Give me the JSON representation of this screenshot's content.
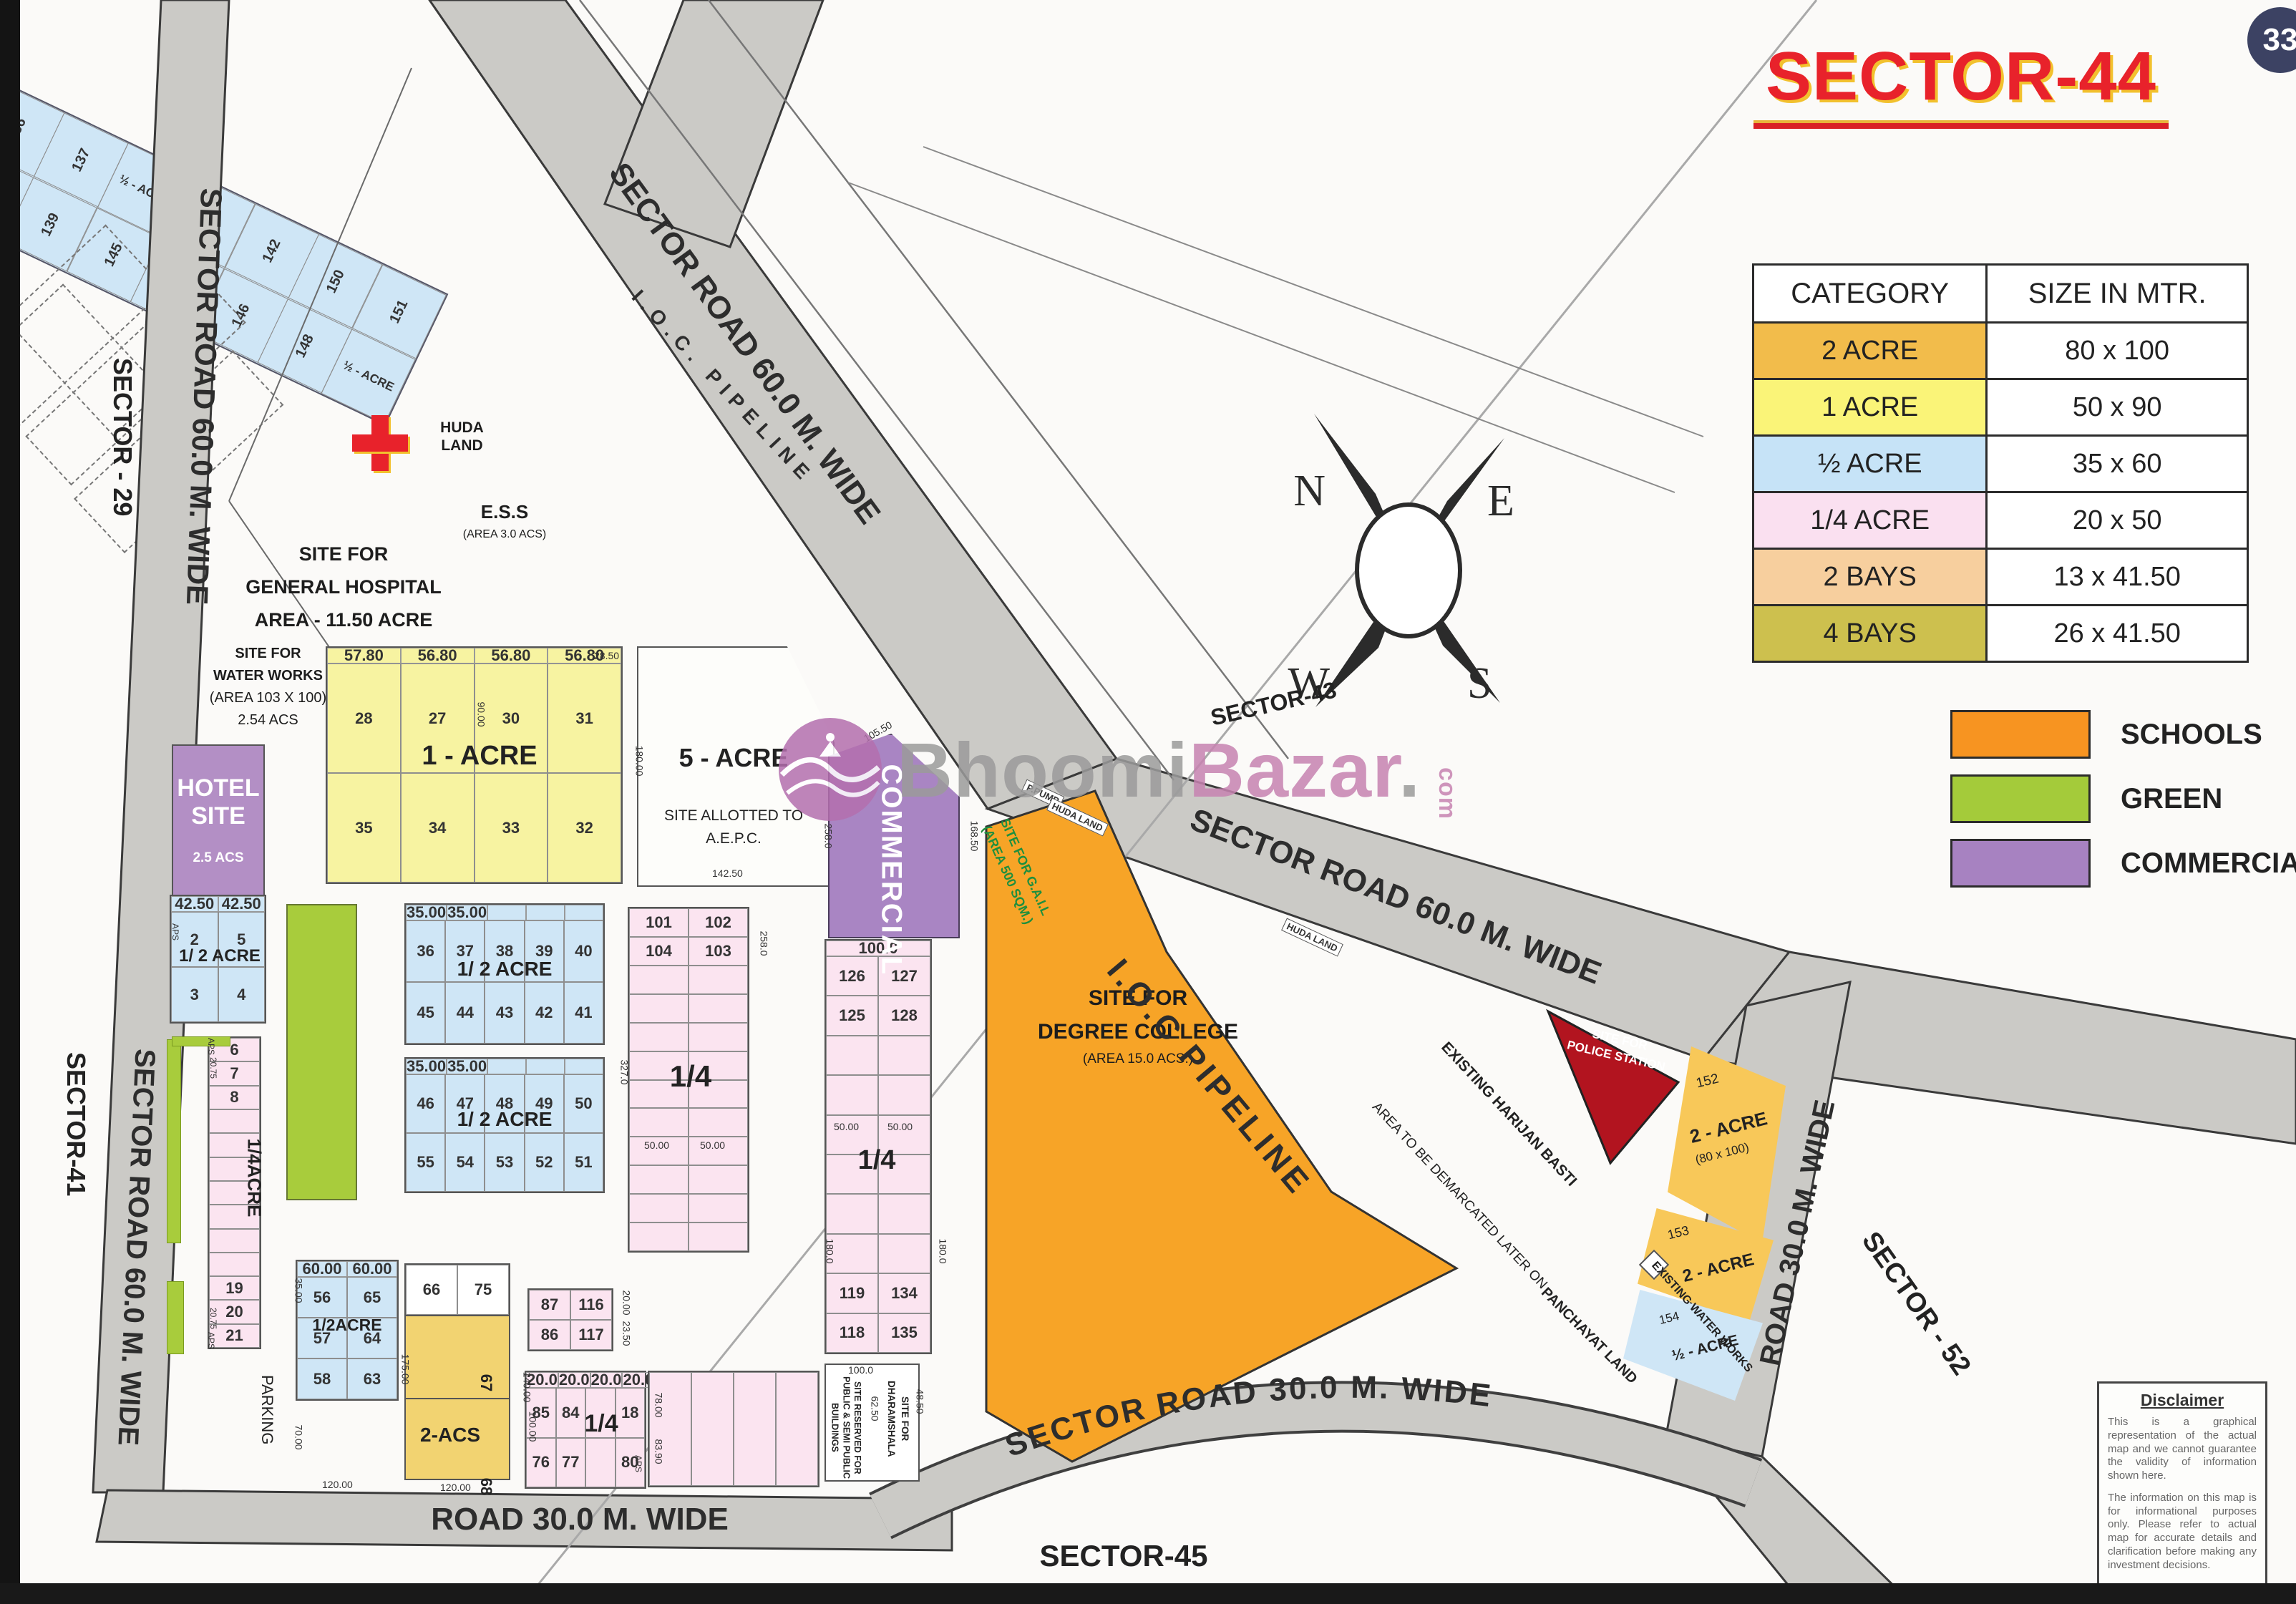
{
  "title": {
    "text": "SECTOR-44",
    "badge": "33"
  },
  "category_table": {
    "headers": [
      "CATEGORY",
      "SIZE IN MTR."
    ],
    "rows": [
      {
        "category": "2 ACRE",
        "size": "80 x 100",
        "color": "#f2bc4b"
      },
      {
        "category": "1 ACRE",
        "size": "50 x 90",
        "color": "#faf478"
      },
      {
        "category": "½ ACRE",
        "size": "35 x 60",
        "color": "#c6e3f7"
      },
      {
        "category": "1/4 ACRE",
        "size": "20 x 50",
        "color": "#fae0f0"
      },
      {
        "category": "2 BAYS",
        "size": "13 x 41.50",
        "color": "#f7cf9e"
      },
      {
        "category": "4 BAYS",
        "size": "26 x 41.50",
        "color": "#cdc04e"
      }
    ]
  },
  "legend": [
    {
      "label": "SCHOOLS",
      "color": "#f79421"
    },
    {
      "label": "GREEN",
      "color": "#a4cb3a"
    },
    {
      "label": "COMMERCIAL",
      "color": "#a782c1"
    }
  ],
  "compass": {
    "n": "N",
    "e": "E",
    "w": "W",
    "s": "S"
  },
  "watermark": {
    "part1": "Bhoomi",
    "part2": "Bazar",
    "dot": ".",
    "part3": "com"
  },
  "roads": {
    "left_60_a": "SECTOR ROAD 60.0 M. WIDE",
    "left_60_b": "SECTOR ROAD 60.0 M. WIDE",
    "diag_60_a": "SECTOR ROAD 60.0 M. WIDE",
    "diag_60_b": "SECTOR ROAD 60.0 M. WIDE",
    "right_30": "ROAD 30.0 M. WIDE",
    "bottom_30": "ROAD 30.0 M. WIDE",
    "curve_30": "SECTOR ROAD 30.0 M. WIDE",
    "ioc_top": "I.O.C. PIPELINE",
    "ioc_mid": "I.O.C PIPELINE"
  },
  "sectors": {
    "s29": "SECTOR - 29",
    "s41": "SECTOR-41",
    "s43": "SECTOR-43",
    "s45": "SECTOR-45",
    "s52": "SECTOR - 52"
  },
  "sites": {
    "hospital": [
      "SITE FOR",
      "GENERAL HOSPITAL",
      "AREA - 11.50 ACRE"
    ],
    "huda": [
      "HUDA",
      "LAND"
    ],
    "ess": "E.S.S",
    "ess_area": "(AREA 3.0 ACS)",
    "water_works": [
      "SITE FOR",
      "WATER WORKS",
      "(AREA 103 X 100)",
      "2.54 ACS"
    ],
    "hotel": [
      "HOTEL",
      "SITE",
      "2.5 ACS"
    ],
    "five_acre": "5 - ACRE",
    "aepc1": "SITE ALLOTTED TO",
    "aepc2": "A.E.P.C.",
    "commercial": "COMMERCIAL",
    "gail1": "SITE FOR G.A.I.L",
    "gail2": "(AREA 500 SQM.)",
    "college": [
      "SITE FOR",
      "DEGREE COLLEGE",
      "(AREA 15.0 ACS.)"
    ],
    "police": [
      "SITE FOR",
      "POLICE STATION"
    ],
    "dharamshala": [
      "SITE FOR",
      "DHARAMSHALA"
    ],
    "public_bldg": [
      "SITE RESERVED FOR",
      "PUBLIC & SEMI PUBLIC",
      "BUILDINGS"
    ],
    "harijan": "EXISTING HARIJAN BASTI",
    "demarcated": "AREA TO BE DEMARCATED LATER ON",
    "panchayat": "PANCHAYAT LAND",
    "eww": "EXISTING WATER WORKS",
    "parking": "PARKING",
    "huda_small": "HUDA LAND",
    "ppump": "P.PUMP"
  },
  "blocks": {
    "one_acre": {
      "dims_top": [
        "57.80",
        "56.80",
        "56.80",
        "56.80"
      ],
      "rows": [
        [
          "28",
          "27",
          "30",
          "31"
        ],
        [
          "35",
          "34",
          "33",
          "32"
        ]
      ],
      "label": "1 - ACRE"
    },
    "half_a": {
      "dims_top": [
        "42.50",
        "42.50"
      ],
      "rows": [
        [
          "2",
          "5"
        ],
        [
          "3",
          "4"
        ]
      ],
      "label": "1/ 2 ACRE"
    },
    "half_b": {
      "dims_top": [
        "35.00",
        "35.00",
        "",
        "",
        ""
      ],
      "rows": [
        [
          "36",
          "37",
          "38",
          "39",
          "40"
        ],
        [
          "45",
          "44",
          "43",
          "42",
          "41"
        ]
      ],
      "label": "1/ 2 ACRE"
    },
    "half_c": {
      "dims_top": [
        "35.00",
        "35.00",
        "",
        "",
        ""
      ],
      "rows": [
        [
          "46",
          "47",
          "48",
          "49",
          "50"
        ],
        [
          "55",
          "54",
          "53",
          "52",
          "51"
        ]
      ],
      "label": "1/ 2 ACRE"
    },
    "half_d": {
      "dims_top": [
        "60.00",
        "60.00"
      ],
      "rows": [
        [
          "56",
          "65"
        ],
        [
          "57",
          "64"
        ],
        [
          "58",
          "63"
        ]
      ],
      "label": "1/2ACRE"
    },
    "r59": "59 TO 62",
    "two_acs": {
      "top": [
        "66",
        "75"
      ],
      "label": "2-ACS",
      "n67": "67",
      "n68": "68"
    },
    "pink_strip": {
      "cells": [
        "6",
        "7",
        "8",
        "",
        "",
        "",
        "",
        "",
        "",
        "",
        "19",
        "20",
        "21"
      ],
      "label": "1/4ACRE"
    },
    "pink_big": {
      "rows": [
        [
          "101",
          "102"
        ],
        [
          "104",
          "103"
        ],
        [
          "",
          ""
        ],
        [
          "",
          ""
        ],
        [
          "",
          ""
        ],
        [
          "",
          ""
        ],
        [
          "",
          ""
        ],
        [
          "",
          ""
        ],
        [
          "",
          ""
        ],
        [
          "",
          ""
        ],
        [
          "",
          ""
        ],
        [
          "",
          ""
        ]
      ],
      "label": "1/4"
    },
    "center_pink": {
      "dims_top": [
        "100.0"
      ],
      "rows": [
        [
          "126",
          "127"
        ],
        [
          "125",
          "128"
        ],
        [
          "",
          ""
        ],
        [
          "",
          ""
        ],
        [
          "",
          ""
        ],
        [
          "",
          ""
        ],
        [
          "",
          ""
        ],
        [
          "",
          ""
        ],
        [
          "119",
          "134"
        ],
        [
          "118",
          "135"
        ]
      ],
      "label": "1/4"
    },
    "pink87": {
      "rows": [
        [
          "87",
          "116"
        ],
        [
          "86",
          "117"
        ]
      ]
    },
    "pink85": {
      "dims_top": [
        "20.0",
        "20.0",
        "20.0",
        "20.0"
      ],
      "rows": [
        [
          "85",
          "84",
          "",
          "18"
        ],
        [
          "76",
          "77",
          "",
          "80"
        ]
      ],
      "label": "1/4"
    },
    "pinkfill": {
      "rows": [
        [
          "",
          "",
          "",
          ""
        ]
      ]
    },
    "diag": {
      "rows": [
        [
          "136",
          "137",
          "½ - ACRE",
          "141",
          "142",
          "150",
          "151"
        ],
        [
          "138",
          "139",
          "145",
          "143",
          "146",
          "148",
          "½ - ACRE"
        ]
      ]
    },
    "p152": {
      "no": "152",
      "a": "2 - ACRE",
      "s": "(80 x 100)"
    },
    "p153": {
      "no": "153",
      "a": "2 - ACRE"
    },
    "p154": {
      "no": "154",
      "a": "½ - ACRE"
    }
  },
  "dims": {
    "d90": "90.00",
    "d180": "180.00",
    "d142": "142.50",
    "d2850": "28.50",
    "d258a": "258.0",
    "d327": "327.0",
    "d50a": "50.00",
    "d50b": "50.00",
    "d50c": "50.00",
    "d50d": "50.00",
    "d2000": "20.00",
    "d2350": "23.50",
    "d175": "175.00",
    "d140": "140.00",
    "d35": "35.00",
    "d120a": "120.00",
    "d120b": "120.00",
    "d70": "70.00",
    "d180b": "180.0",
    "d180c": "180.0",
    "d100": "100.0",
    "d6250": "62.50",
    "d4850": "48.50",
    "d10550": "105.50",
    "d16850": "168.50",
    "d258b": "258.0",
    "d2075a": "20.75",
    "daps1": "APS",
    "d2075b": "20.75",
    "daps2": "APS",
    "d100b": "100.00",
    "d7800": "78.00",
    "d8390": "83.90",
    "daps3": "APS",
    "daps4": "APS"
  },
  "disclaimer": {
    "title": "Disclaimer",
    "p1": "This is a graphical representation of the actual map and we cannot guarantee the validity of information shown here.",
    "p2": "The information on this map is for informational purposes only. Please refer to actual map for accurate details and clarification before making any investment decisions."
  }
}
